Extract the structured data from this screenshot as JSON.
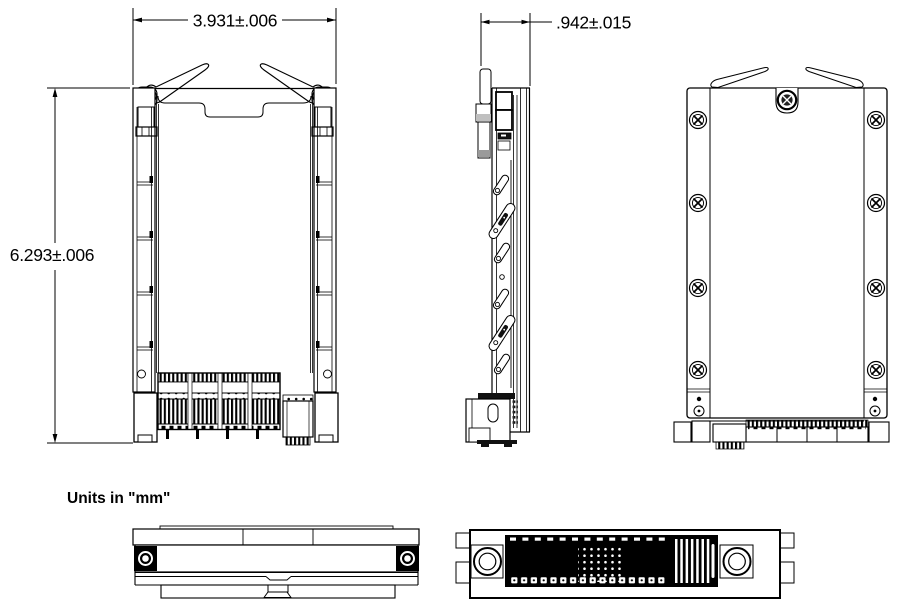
{
  "annotations": {
    "width_dim": "3.931±.006",
    "height_dim": "6.293±.006",
    "depth_dim": ".942±.015",
    "units_note": "Units in \"mm\""
  },
  "colors": {
    "line": "#000000",
    "background": "#ffffff",
    "connector_fill": "#000000"
  }
}
